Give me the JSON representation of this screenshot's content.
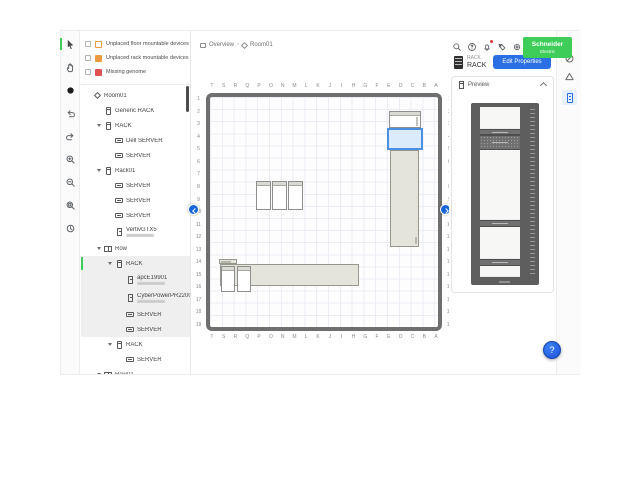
{
  "colors": {
    "brand_green": "#3dcd58",
    "accent_blue": "#2b6fe4",
    "selection_blue": "#4a8fe2",
    "warning_orange": "#e89c3f",
    "error_red": "#e05252"
  },
  "header": {
    "logo_line1": "Schneider",
    "logo_line2": "Electric",
    "icons": [
      "search-icon",
      "help-icon",
      "notifications-icon",
      "feedback-icon",
      "settings-icon",
      "avatar"
    ]
  },
  "toolbar": {
    "tools": [
      "select-tool",
      "pan-tool",
      "dot-tool",
      "undo",
      "redo",
      "zoom-in",
      "zoom-out",
      "fit-view",
      "history"
    ]
  },
  "breadcrumb": {
    "overview": "Overview",
    "separator": "›",
    "room": "Room01"
  },
  "filters": {
    "items": [
      {
        "label": "Unplaced floor mountable devices",
        "icon": "floor-device-icon",
        "color": "#e89c3f",
        "variant": "outline"
      },
      {
        "label": "Unplaced rack mountable devices",
        "icon": "rack-device-icon",
        "color": "#e89c3f",
        "variant": "filled"
      },
      {
        "label": "Missing genome",
        "icon": "missing-genome-icon",
        "color": "#e05252",
        "variant": "filled"
      }
    ]
  },
  "tree": {
    "items": [
      {
        "level": 0,
        "icon": "room",
        "label": "Room01",
        "chevron": false
      },
      {
        "level": 1,
        "icon": "rack",
        "label": "Generic RACK",
        "chevron": false
      },
      {
        "level": 1,
        "icon": "rack",
        "label": "RACK",
        "chevron": true
      },
      {
        "level": 2,
        "icon": "server",
        "label": "Dell SERVER",
        "chevron": false
      },
      {
        "level": 2,
        "icon": "server",
        "label": "SERVER",
        "chevron": false
      },
      {
        "level": 1,
        "icon": "rack",
        "label": "Rack01",
        "chevron": true
      },
      {
        "level": 2,
        "icon": "server",
        "label": "SERVER",
        "chevron": false
      },
      {
        "level": 2,
        "icon": "server",
        "label": "SERVER",
        "chevron": false
      },
      {
        "level": 2,
        "icon": "server",
        "label": "SERVER",
        "chevron": false
      },
      {
        "level": 2,
        "icon": "device",
        "label": "VertivGTX5",
        "chevron": false,
        "redacted": true
      },
      {
        "level": 1,
        "icon": "row",
        "label": "Row",
        "chevron": true
      },
      {
        "level": 2,
        "icon": "rack",
        "label": "RACK",
        "chevron": true,
        "selected": true,
        "in_selection": true
      },
      {
        "level": 3,
        "icon": "device",
        "label": "apcE19901",
        "chevron": false,
        "redacted": true,
        "in_selection": true
      },
      {
        "level": 3,
        "icon": "device",
        "label": "CyberPowerPR2200R...",
        "chevron": false,
        "redacted": true,
        "in_selection": true
      },
      {
        "level": 3,
        "icon": "server",
        "label": "SERVER",
        "chevron": false,
        "in_selection": true
      },
      {
        "level": 3,
        "icon": "server",
        "label": "SERVER",
        "chevron": false,
        "in_selection": true
      },
      {
        "level": 2,
        "icon": "rack",
        "label": "RACK",
        "chevron": true
      },
      {
        "level": 3,
        "icon": "server",
        "label": "SERVER",
        "chevron": false
      },
      {
        "level": 1,
        "icon": "row",
        "label": "Row01",
        "chevron": true
      }
    ]
  },
  "canvas": {
    "column_labels": [
      "T",
      "S",
      "R",
      "Q",
      "P",
      "O",
      "N",
      "M",
      "L",
      "K",
      "J",
      "I",
      "H",
      "G",
      "F",
      "E",
      "D",
      "C",
      "B",
      "A"
    ],
    "row_labels": [
      "1",
      "2",
      "3",
      "4",
      "5",
      "6",
      "7",
      "8",
      "9",
      "10",
      "11",
      "12",
      "13",
      "14",
      "15",
      "16",
      "17",
      "18",
      "19"
    ],
    "objects": [
      {
        "type": "rack",
        "position": "top-right",
        "state": "normal"
      },
      {
        "type": "rack",
        "position": "top-right",
        "state": "selected"
      },
      {
        "type": "row",
        "position": "right-vertical",
        "state": "normal"
      },
      {
        "type": "rack",
        "position": "center",
        "state": "normal"
      },
      {
        "type": "rack",
        "position": "center",
        "state": "normal"
      },
      {
        "type": "rack",
        "position": "center",
        "state": "normal"
      },
      {
        "type": "row",
        "position": "bottom",
        "state": "normal"
      },
      {
        "type": "rack",
        "position": "bottom-left",
        "state": "normal"
      },
      {
        "type": "rack",
        "position": "bottom-left",
        "state": "normal"
      }
    ]
  },
  "properties": {
    "type_label": "RACK",
    "name": "RACK",
    "edit_button_label": "Edit Properties",
    "preview_title": "Preview"
  },
  "preview": {
    "units": [
      {
        "kind": "empty",
        "u": 22
      },
      {
        "kind": "device",
        "u": 6
      },
      {
        "kind": "ports",
        "u": 15
      },
      {
        "kind": "empty",
        "u": 70
      },
      {
        "kind": "device",
        "u": 7
      },
      {
        "kind": "empty",
        "u": 32
      },
      {
        "kind": "device",
        "u": 7
      },
      {
        "kind": "empty",
        "u": 11
      }
    ]
  },
  "right_strip": {
    "tabs": [
      "status-circle-icon",
      "alerts-icon",
      "rack-properties-tab"
    ]
  },
  "fab": {
    "label": "?"
  }
}
